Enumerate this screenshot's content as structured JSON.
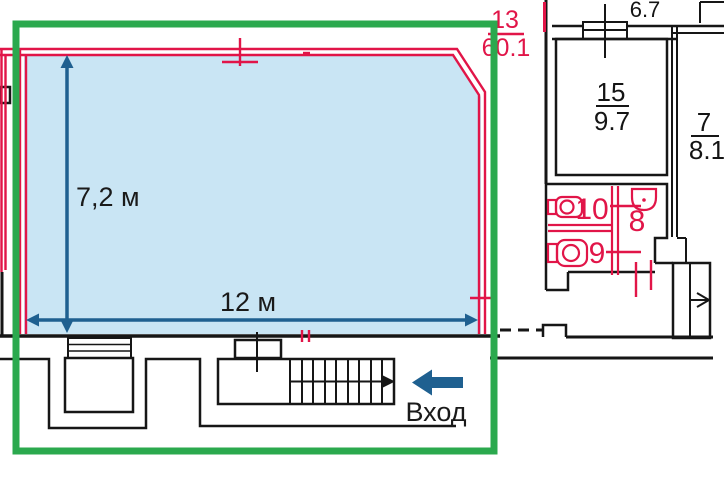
{
  "plan": {
    "highlighted_area": {
      "number": "13",
      "area": "60.1"
    },
    "rooms": {
      "room6": {
        "area": "6.7"
      },
      "room15": {
        "number": "15",
        "area": "9.7"
      },
      "room7": {
        "number": "7",
        "area": "8.1"
      },
      "wc10": {
        "label": "10"
      },
      "wc9": {
        "label": "9"
      },
      "wc8": {
        "label": "8"
      }
    },
    "dimensions": {
      "depth": "7,2 м",
      "width": "12 м"
    },
    "entrance": {
      "label": "Вход"
    },
    "colors": {
      "highlight_green": "#2ba94e",
      "wall_red": "#e11548",
      "room_fill_blue": "#c9e5f4",
      "dimension_teal": "#1f6090",
      "wall_black": "#161616"
    }
  }
}
